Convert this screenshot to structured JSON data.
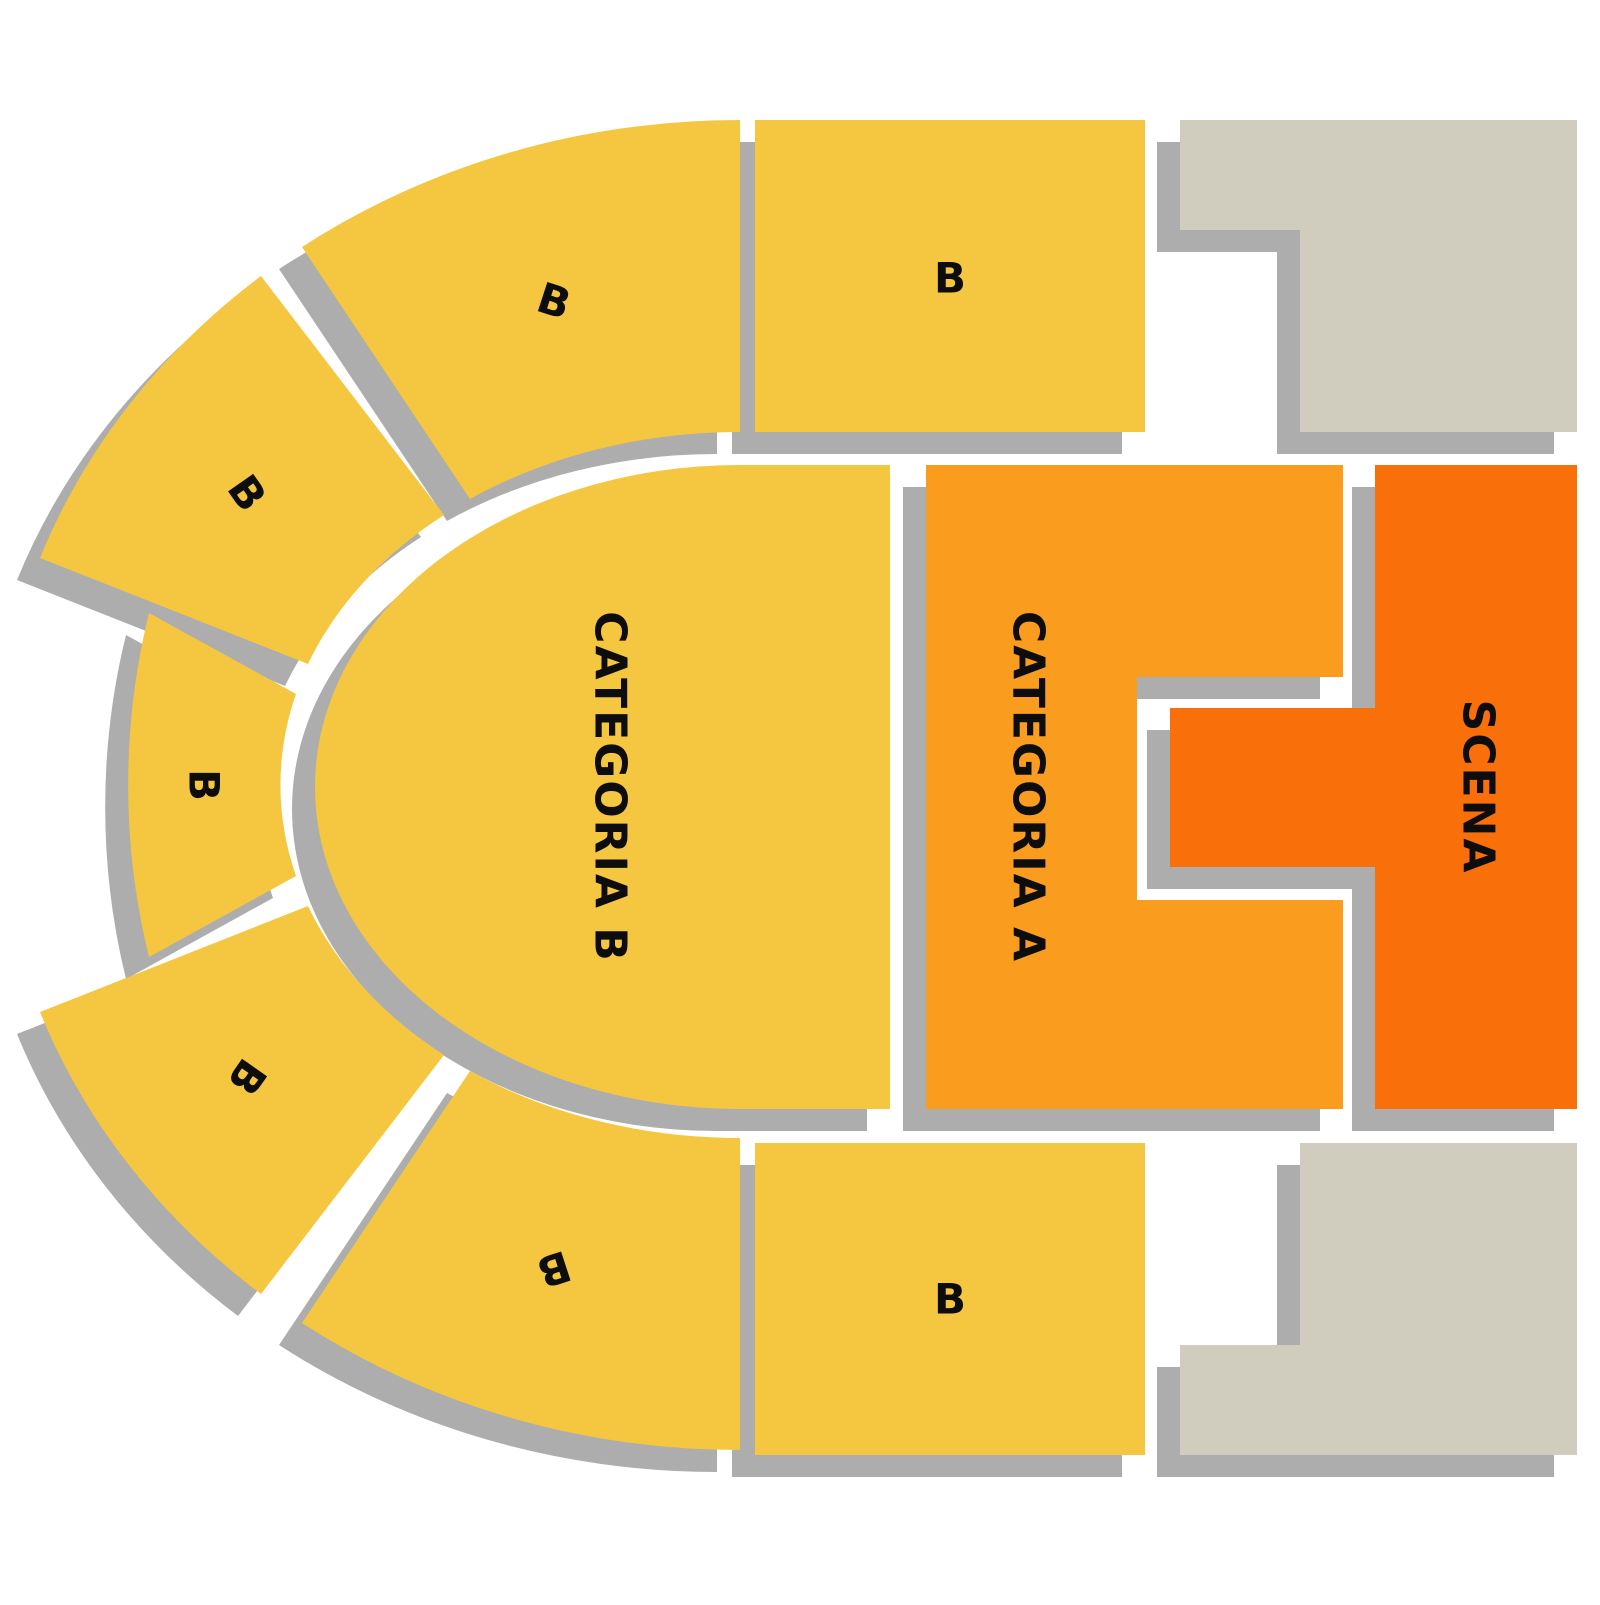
{
  "map": {
    "type": "venue-seating-map",
    "sections": [
      {
        "id": "arc-top",
        "label": "B",
        "category": "B"
      },
      {
        "id": "arc-upper-left",
        "label": "B",
        "category": "B"
      },
      {
        "id": "arc-left",
        "label": "B",
        "category": "B"
      },
      {
        "id": "arc-lower-left",
        "label": "B",
        "category": "B"
      },
      {
        "id": "arc-bottom",
        "label": "B",
        "category": "B"
      },
      {
        "id": "block-top",
        "label": "B",
        "category": "B"
      },
      {
        "id": "block-bottom",
        "label": "B",
        "category": "B"
      },
      {
        "id": "categoria-b",
        "label": "CATEGORIA B",
        "category": "B"
      },
      {
        "id": "categoria-a",
        "label": "CATEGORIA A",
        "category": "A"
      },
      {
        "id": "scena",
        "label": "SCENA",
        "category": "stage"
      }
    ]
  },
  "colors": {
    "category_b": "#F5C740",
    "category_a": "#FA9D1E",
    "stage": "#F9700A",
    "structure": "#D0CDBE",
    "shadow": "#ADADAD",
    "label": "#0D0D0D",
    "background": "#FFFFFF"
  }
}
